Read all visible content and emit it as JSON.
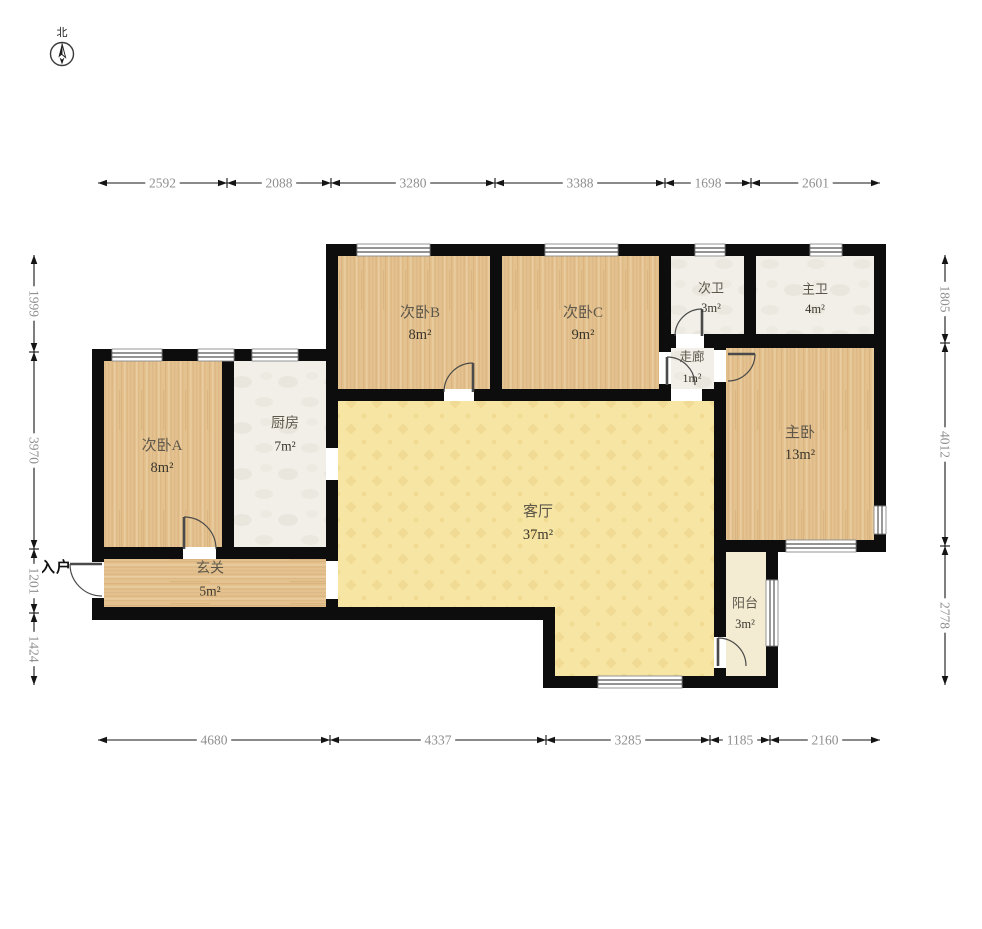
{
  "compass": {
    "label": "北"
  },
  "entry": {
    "label": "入户"
  },
  "colors": {
    "wall": "#0d0d0d",
    "wood": "#e4c28f",
    "wood_grain": "#d2a873",
    "wood_light": "#f0d8ad",
    "tile": "#f1efe8",
    "tile_mottle": "#e2ded2",
    "living": "#f6e5a3",
    "living_pattern": "#ecd184",
    "balcony": "#f3ecd3",
    "dim_line": "#141414",
    "dim_text": "#8f8f8f",
    "room_name": "#5d574b",
    "room_area": "#3a362c",
    "door": "#4a4a4a",
    "window_frame": "#8a8a8a",
    "window_glass": "#555555"
  },
  "rooms": [
    {
      "id": "bedroom-b",
      "name": "次卧B",
      "area": "8m²",
      "floor": "wood_v",
      "rect": [
        332,
        250,
        164,
        145
      ],
      "label": [
        420,
        313,
        335
      ],
      "fs": 15
    },
    {
      "id": "bedroom-c",
      "name": "次卧C",
      "area": "9m²",
      "floor": "wood_v",
      "rect": [
        496,
        250,
        169,
        145
      ],
      "label": [
        583,
        313,
        335
      ],
      "fs": 15
    },
    {
      "id": "bath-secondary",
      "name": "次卫",
      "area": "3m²",
      "floor": "tile",
      "rect": [
        665,
        250,
        85,
        90
      ],
      "label": [
        711,
        288,
        308
      ],
      "fs": 13
    },
    {
      "id": "bath-master",
      "name": "主卫",
      "area": "4m²",
      "floor": "tile",
      "rect": [
        750,
        250,
        130,
        90
      ],
      "label": [
        815,
        289,
        309
      ],
      "fs": 13
    },
    {
      "id": "corridor",
      "name": "走廊",
      "area": "1m²",
      "floor": "tile",
      "rect": [
        665,
        340,
        55,
        55
      ],
      "label": [
        692,
        357,
        378
      ],
      "fs": 12.5
    },
    {
      "id": "master-bedroom",
      "name": "主卧",
      "area": "13m²",
      "floor": "wood_v",
      "rect": [
        720,
        340,
        160,
        206
      ],
      "label": [
        800,
        433,
        455
      ],
      "fs": 15
    },
    {
      "id": "bedroom-a",
      "name": "次卧A",
      "area": "8m²",
      "floor": "wood_v",
      "rect": [
        98,
        355,
        130,
        198
      ],
      "label": [
        162,
        446,
        468
      ],
      "fs": 15
    },
    {
      "id": "kitchen",
      "name": "厨房",
      "area": "7m²",
      "floor": "tile",
      "rect": [
        228,
        355,
        104,
        198
      ],
      "label": [
        285,
        424,
        446
      ],
      "fs": 14
    },
    {
      "id": "entry-hall",
      "name": "玄关",
      "area": "5m²",
      "floor": "wood_h",
      "rect": [
        98,
        553,
        234,
        60
      ],
      "label": [
        210,
        569,
        591
      ],
      "fs": 14
    },
    {
      "id": "living-room",
      "name": "客厅",
      "area": "37m²",
      "floor": "living",
      "poly": "332,395 720,395 720,680 549,680 549,613 332,613",
      "label": [
        538,
        512,
        535
      ],
      "fs": 15
    },
    {
      "id": "balcony",
      "name": "阳台",
      "area": "3m²",
      "floor": "balcony",
      "rect": [
        720,
        546,
        52,
        136
      ],
      "label": [
        745,
        603,
        624
      ],
      "fs": 13
    }
  ],
  "walls": [
    [
      326,
      244,
      560,
      12
    ],
    [
      874,
      244,
      12,
      308
    ],
    [
      714,
      540,
      172,
      12
    ],
    [
      766,
      552,
      12,
      136
    ],
    [
      543,
      676,
      235,
      12
    ],
    [
      543,
      607,
      12,
      81
    ],
    [
      92,
      607,
      463,
      13
    ],
    [
      92,
      349,
      12,
      271
    ],
    [
      92,
      349,
      246,
      12
    ],
    [
      326,
      244,
      12,
      376
    ],
    [
      222,
      361,
      12,
      198
    ],
    [
      104,
      547,
      234,
      12
    ],
    [
      490,
      256,
      12,
      145
    ],
    [
      659,
      256,
      12,
      145
    ],
    [
      744,
      256,
      12,
      90
    ],
    [
      659,
      334,
      227,
      14
    ],
    [
      714,
      334,
      12,
      218
    ],
    [
      326,
      389,
      400,
      12
    ],
    [
      714,
      552,
      12,
      124
    ]
  ],
  "openings": [
    [
      92,
      562,
      12,
      36
    ],
    [
      183,
      547,
      33,
      12
    ],
    [
      326,
      561,
      12,
      38
    ],
    [
      326,
      448,
      12,
      32
    ],
    [
      444,
      389,
      30,
      12
    ],
    [
      671,
      389,
      31,
      12
    ],
    [
      659,
      352,
      12,
      32
    ],
    [
      714,
      350,
      12,
      32
    ],
    [
      676,
      334,
      28,
      14
    ],
    [
      714,
      637,
      12,
      31
    ]
  ],
  "windows": [
    {
      "rect": [
        357,
        244,
        73,
        12
      ],
      "dir": "h"
    },
    {
      "rect": [
        545,
        244,
        73,
        12
      ],
      "dir": "h"
    },
    {
      "rect": [
        695,
        244,
        30,
        12
      ],
      "dir": "h"
    },
    {
      "rect": [
        810,
        244,
        32,
        12
      ],
      "dir": "h"
    },
    {
      "rect": [
        112,
        349,
        50,
        12
      ],
      "dir": "h"
    },
    {
      "rect": [
        198,
        349,
        36,
        12
      ],
      "dir": "h"
    },
    {
      "rect": [
        252,
        349,
        46,
        12
      ],
      "dir": "h"
    },
    {
      "rect": [
        874,
        506,
        12,
        28
      ],
      "dir": "v"
    },
    {
      "rect": [
        786,
        540,
        70,
        12
      ],
      "dir": "h"
    },
    {
      "rect": [
        766,
        580,
        12,
        66
      ],
      "dir": "v"
    },
    {
      "rect": [
        598,
        676,
        84,
        12
      ],
      "dir": "h"
    }
  ],
  "doors": [
    {
      "id": "entry-door",
      "hinge": [
        102,
        564
      ],
      "tip": [
        70,
        564
      ],
      "end": [
        102,
        596
      ]
    },
    {
      "id": "bedroom-a-door",
      "hinge": [
        184,
        549
      ],
      "tip": [
        184,
        517
      ],
      "end": [
        216,
        549
      ]
    },
    {
      "id": "bedroom-b-door",
      "hinge": [
        473,
        392
      ],
      "tip": [
        473,
        363
      ],
      "end": [
        444,
        392
      ]
    },
    {
      "id": "bath-secondary-door",
      "hinge": [
        702,
        336
      ],
      "tip": [
        702,
        309
      ],
      "end": [
        675,
        336
      ]
    },
    {
      "id": "bedroom-c-door",
      "hinge": [
        667,
        385
      ],
      "tip": [
        667,
        357
      ],
      "end": [
        695,
        385
      ]
    },
    {
      "id": "master-bedroom-door",
      "hinge": [
        728,
        354
      ],
      "tip": [
        755,
        354
      ],
      "end": [
        728,
        381
      ]
    },
    {
      "id": "balcony-door",
      "hinge": [
        718,
        666
      ],
      "tip": [
        718,
        638
      ],
      "end": [
        746,
        666
      ]
    }
  ],
  "dimensions": {
    "top": {
      "axis": "h",
      "pos": 183,
      "segments": [
        {
          "from": 98,
          "to": 227,
          "label": "2592"
        },
        {
          "from": 227,
          "to": 331,
          "label": "2088"
        },
        {
          "from": 331,
          "to": 495,
          "label": "3280"
        },
        {
          "from": 495,
          "to": 665,
          "label": "3388"
        },
        {
          "from": 665,
          "to": 751,
          "label": "1698"
        },
        {
          "from": 751,
          "to": 880,
          "label": "2601"
        }
      ]
    },
    "bottom": {
      "axis": "h",
      "pos": 740,
      "segments": [
        {
          "from": 98,
          "to": 330,
          "label": "4680"
        },
        {
          "from": 330,
          "to": 546,
          "label": "4337"
        },
        {
          "from": 546,
          "to": 710,
          "label": "3285"
        },
        {
          "from": 710,
          "to": 770,
          "label": "1185"
        },
        {
          "from": 770,
          "to": 880,
          "label": "2160"
        }
      ]
    },
    "left": {
      "axis": "v",
      "pos": 34,
      "segments": [
        {
          "from": 255,
          "to": 352,
          "label": "1999"
        },
        {
          "from": 352,
          "to": 549,
          "label": "3970"
        },
        {
          "from": 549,
          "to": 613,
          "label": "1201"
        },
        {
          "from": 613,
          "to": 685,
          "label": "1424"
        }
      ]
    },
    "right": {
      "axis": "v",
      "pos": 945,
      "segments": [
        {
          "from": 255,
          "to": 343,
          "label": "1805"
        },
        {
          "from": 343,
          "to": 546,
          "label": "4012"
        },
        {
          "from": 546,
          "to": 685,
          "label": "2778"
        }
      ]
    }
  }
}
